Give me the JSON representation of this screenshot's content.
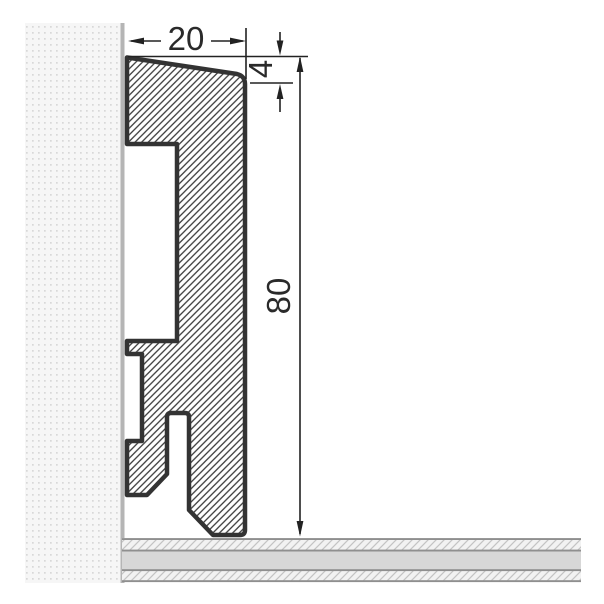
{
  "diagram": {
    "kind": "skirting-board-profile-cross-section",
    "dimensions": {
      "width": {
        "label": "20"
      },
      "bevel": {
        "label": "4"
      },
      "height": {
        "label": "80"
      }
    },
    "colors": {
      "outline": "#333333",
      "hatch": "#3b3b3b",
      "dimension": "#222222",
      "wall_bg": "#f6f6f6",
      "wall_dot": "#d8d8d8",
      "wall_edge": "#b5b5b5",
      "floor_base": "#f2f2f2",
      "floor_hatch": "#c3c3c3",
      "floor_band": "#d7d7d7",
      "floor_line": "#8f8f8f"
    }
  }
}
